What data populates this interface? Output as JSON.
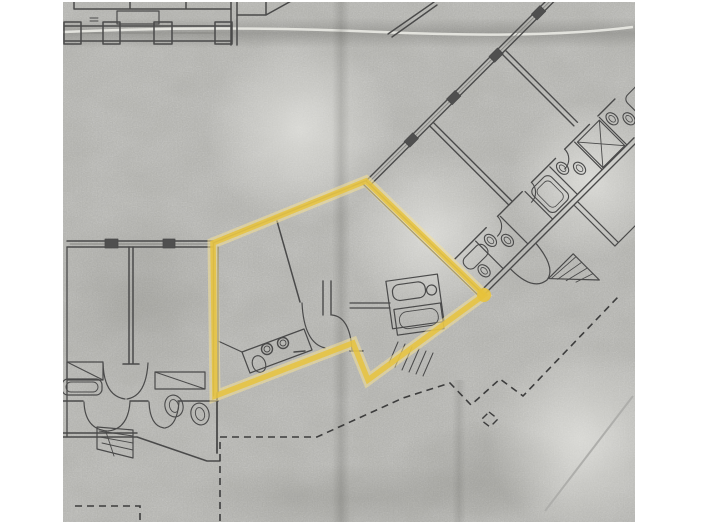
{
  "page": {
    "width": 705,
    "height": 528,
    "background": "#ffffff"
  },
  "scan": {
    "description": "scanned-floor-plan-sheet",
    "background": "#d8d8d6",
    "x": 63,
    "y": 2,
    "width": 572,
    "height": 520
  },
  "plan": {
    "line_color": "#4a4a4a",
    "thin_line_color": "#878783",
    "wall_fill": "#4f4f4f"
  },
  "highlight": {
    "label": "highlighted-unit-boundary",
    "color": "#e7c23a",
    "halo_color": "#f4e096",
    "points": "213,243 366,181 484,295 447,322 368,380 353,343 215,396",
    "corner_dot": {
      "cx": 484,
      "cy": 295,
      "r": 7
    }
  },
  "parcel": {
    "dash_color": "#3d3d3d",
    "dash_pattern": "7 5",
    "main_path": "M220 521 L220 437 L317 437 L403 398 L450 383 L471 405 L500 379 L523 396 L618 297",
    "diamond_path": "M489 412 L498 419 L490 427 L481 420 Z",
    "corner_path": "M75 506 L140 506 L140 521",
    "faint_color": "#aeaeab",
    "faint_path": "M545 511 L633 396"
  }
}
